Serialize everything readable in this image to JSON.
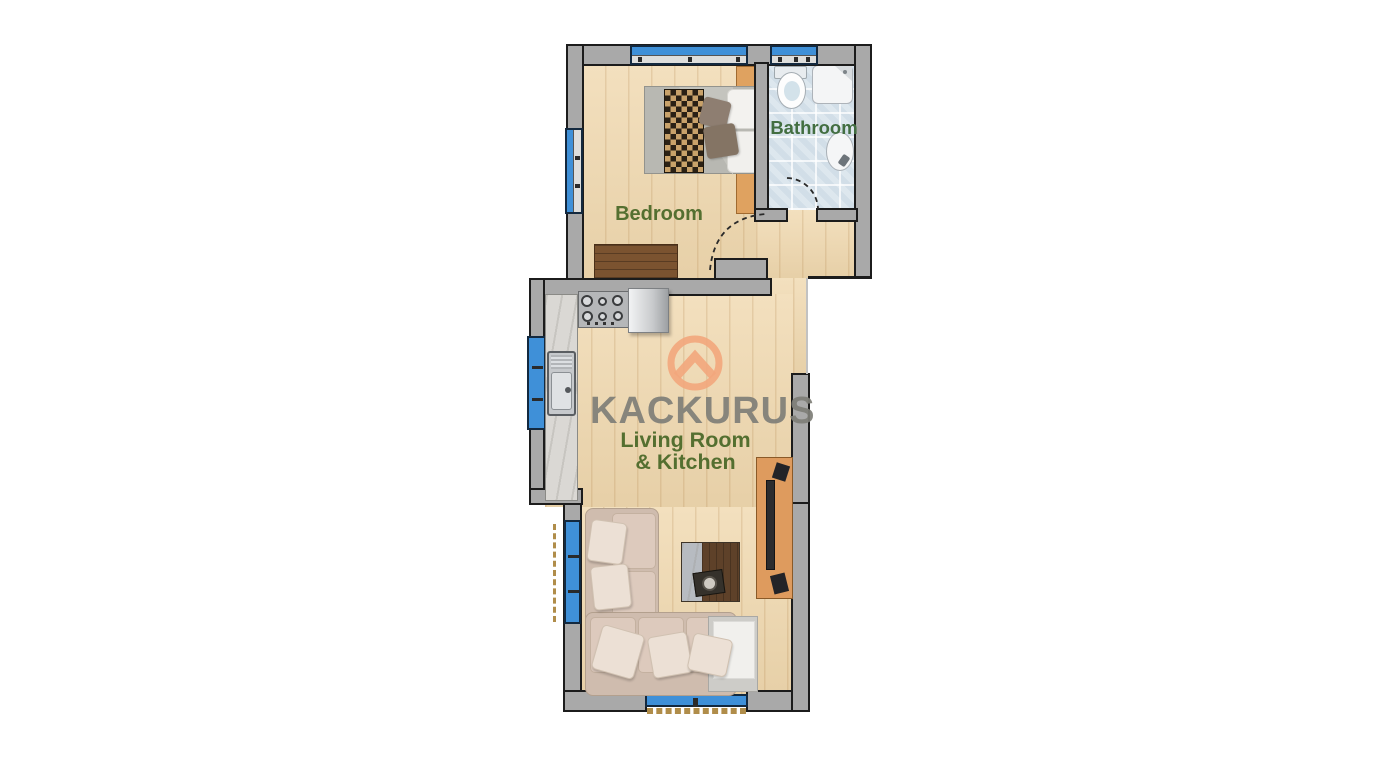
{
  "brand": {
    "name": "KACKURUS"
  },
  "rooms": {
    "bedroom": {
      "label": "Bedroom"
    },
    "bathroom": {
      "label": "Bathroom"
    },
    "living": {
      "label_line1": "Living Room",
      "label_line2": "& Kitchen"
    }
  },
  "colors": {
    "wall_gray": "#a9a9a9",
    "floor_wood": "#f0d8ae",
    "bathroom_tile": "#dde7ee",
    "window_blue": "#3f90d8",
    "label_green": "#546f30",
    "bathroom_label_green": "#426e41",
    "brand_orange": "#f2a67c",
    "brand_gray": "#7e7e77"
  },
  "fixtures": [
    "double-bed",
    "checkered-runner",
    "pillows",
    "nightstand",
    "dresser",
    "toilet",
    "shower",
    "bathroom-sink",
    "bathroom-door",
    "bedroom-door",
    "kitchen-counter",
    "kitchen-sink",
    "stove",
    "refrigerator",
    "corner-sofa",
    "sofa-pillows",
    "side-table",
    "coffee-table",
    "serving-tray",
    "tv-console",
    "tv",
    "speakers",
    "windows",
    "balcony-dashed-lines"
  ]
}
